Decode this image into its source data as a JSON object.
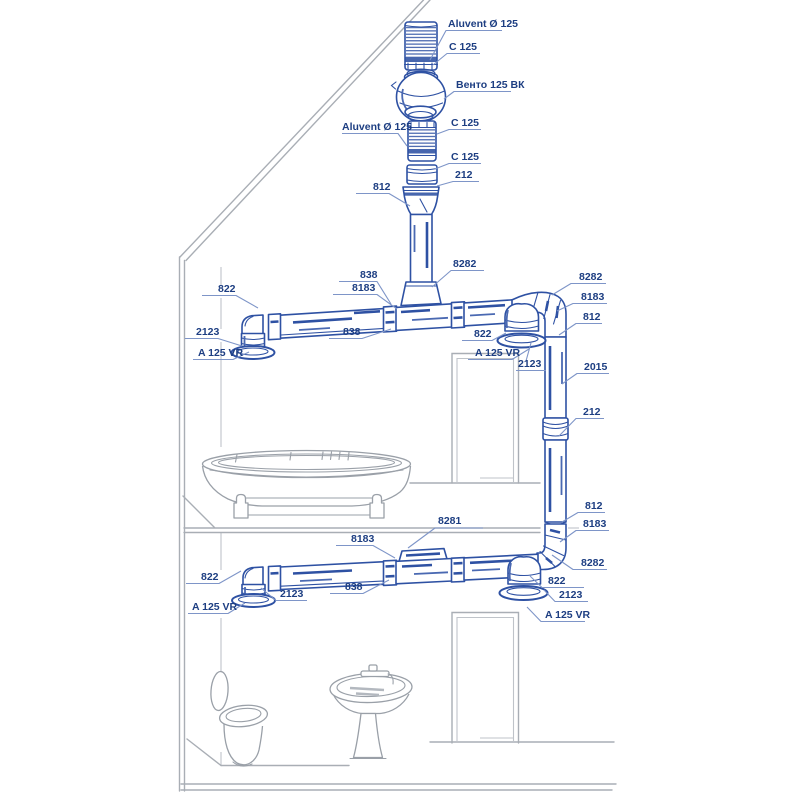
{
  "diagram": {
    "type": "ventilation-installation-diagram",
    "colors": {
      "duct_blue": "#2e51a3",
      "label_navy": "#1d3e82",
      "leader_blue": "#7e95c8",
      "house_gray": "#a9aeb5",
      "fixture_gray": "#9aa0a8",
      "background": "#ffffff"
    }
  },
  "callouts": [
    {
      "id": "aluvent-top",
      "text": "Aluvent Ø 125",
      "x": 448,
      "y": 27,
      "lines": [
        "430,60 446,30.5 502,30.5"
      ]
    },
    {
      "id": "c125-1",
      "text": "C 125",
      "x": 449,
      "y": 50,
      "lines": [
        "433,65 447,53.5 480,53.5"
      ]
    },
    {
      "id": "vento",
      "text": "Венто 125 ВК",
      "x": 456,
      "y": 88,
      "lines": [
        "444,99 454,91.5 511,91.5"
      ]
    },
    {
      "id": "c125-2",
      "text": "C 125",
      "x": 451,
      "y": 126,
      "lines": [
        "437,134 449,129.5 481,129.5"
      ]
    },
    {
      "id": "aluvent-left",
      "text": "Aluvent Ø 125",
      "x": 342,
      "y": 130,
      "lines": [
        "342,133.5 398,133.5 407,146"
      ]
    },
    {
      "id": "c125-3",
      "text": "C 125",
      "x": 451,
      "y": 160,
      "lines": [
        "435,169 449,163.5 481,163.5"
      ]
    },
    {
      "id": "n212-top",
      "text": "212",
      "x": 455,
      "y": 178,
      "lines": [
        "437,186 453,181.5 479,181.5"
      ]
    },
    {
      "id": "n812-top",
      "text": "812",
      "x": 373,
      "y": 190,
      "lines": [
        "356,193.5 389,193.5 410,206"
      ]
    },
    {
      "id": "n8282-top",
      "text": "8282",
      "x": 453,
      "y": 267,
      "lines": [
        "432,287 451,270.5 484,270.5"
      ]
    },
    {
      "id": "n838-top1",
      "text": "838",
      "x": 360,
      "y": 278,
      "lines": [
        "339,281.5 377,281.5 391,304"
      ]
    },
    {
      "id": "n8183-top",
      "text": "8183",
      "x": 352,
      "y": 291,
      "lines": [
        "333,294.5 377,294.5 397,309"
      ]
    },
    {
      "id": "n838-top2",
      "text": "838",
      "x": 343,
      "y": 335,
      "lines": [
        "329,338.5 362,338.5 391,329"
      ]
    },
    {
      "id": "n822-topleft",
      "text": "822",
      "x": 218,
      "y": 292,
      "lines": [
        "202,295.5 236,295.5 258,308"
      ]
    },
    {
      "id": "n2123-topleft",
      "text": "2123",
      "x": 196,
      "y": 335,
      "lines": [
        "185,338.5 218,338.5 242,346"
      ]
    },
    {
      "id": "a125vr-topleft",
      "text": "A 125 VR",
      "x": 198,
      "y": 356,
      "lines": [
        "193,359.5 233,359.5 249,352"
      ]
    },
    {
      "id": "n8282-topright",
      "text": "8282",
      "x": 579,
      "y": 280,
      "lines": [
        "552,295 571,283.5 606,283.5"
      ]
    },
    {
      "id": "n8183-topright",
      "text": "8183",
      "x": 581,
      "y": 300,
      "lines": [
        "557,311 573,303.5 607,303.5"
      ]
    },
    {
      "id": "n812-topright",
      "text": "812",
      "x": 583,
      "y": 320,
      "lines": [
        "559,335 576,323.5 602,323.5"
      ]
    },
    {
      "id": "n822-topmid",
      "text": "822",
      "x": 474,
      "y": 337,
      "lines": [
        "462,340.5 492,340.5 506,333"
      ]
    },
    {
      "id": "a125vr-topmid",
      "text": "A 125 VR",
      "x": 475,
      "y": 356,
      "lines": [
        "468,359.5 512,359.5 529,349"
      ]
    },
    {
      "id": "n2123-topmid",
      "text": "2123",
      "x": 518,
      "y": 367,
      "lines": [
        "531,343 526,361",
        "516,370.5 546,370.5"
      ]
    },
    {
      "id": "n2015",
      "text": "2015",
      "x": 584,
      "y": 370,
      "lines": [
        "562,384 577,373.5 609,373.5"
      ]
    },
    {
      "id": "n212-right",
      "text": "212",
      "x": 583,
      "y": 415,
      "lines": [
        "559,436 576,418.5 604,418.5"
      ]
    },
    {
      "id": "n812-right2",
      "text": "812",
      "x": 585,
      "y": 509,
      "lines": [
        "562,522 578,512.5 605,512.5"
      ]
    },
    {
      "id": "n8183-right2",
      "text": "8183",
      "x": 583,
      "y": 527,
      "lines": [
        "560,542 576,530.5 609,530.5"
      ]
    },
    {
      "id": "n8282-right2",
      "text": "8282",
      "x": 581,
      "y": 566,
      "lines": [
        "552,555 573,569.5 607,569.5"
      ]
    },
    {
      "id": "n8281",
      "text": "8281",
      "x": 438,
      "y": 524,
      "lines": [
        "408,548 435,528 483,528"
      ]
    },
    {
      "id": "n8183-low",
      "text": "8183",
      "x": 351,
      "y": 542,
      "lines": [
        "336,545.5 373,545.5 395,558"
      ]
    },
    {
      "id": "n838-low",
      "text": "838",
      "x": 345,
      "y": 590,
      "lines": [
        "330,593.5 363,593.5 389,580"
      ]
    },
    {
      "id": "n822-lowright",
      "text": "822",
      "x": 548,
      "y": 584,
      "lines": [
        "530,576 542,587.5 584,587.5"
      ]
    },
    {
      "id": "n2123-lowright",
      "text": "2123",
      "x": 559,
      "y": 598,
      "lines": [
        "544,590 555,601.5 588,601.5"
      ]
    },
    {
      "id": "a125vr-lowright",
      "text": "A 125 VR",
      "x": 545,
      "y": 618,
      "lines": [
        "527,607 541,621.5 585,621.5"
      ]
    },
    {
      "id": "n822-lowleft",
      "text": "822",
      "x": 201,
      "y": 580,
      "lines": [
        "186,583.5 219,583.5 241,571"
      ]
    },
    {
      "id": "n2123-lowleft",
      "text": "2123",
      "x": 280,
      "y": 597,
      "lines": [
        "261,588 276,600.5 307,600.5"
      ]
    },
    {
      "id": "a125vr-lowleft",
      "text": "A 125 VR",
      "x": 192,
      "y": 610,
      "lines": [
        "188,613.5 228,613.5 245,603"
      ]
    }
  ]
}
